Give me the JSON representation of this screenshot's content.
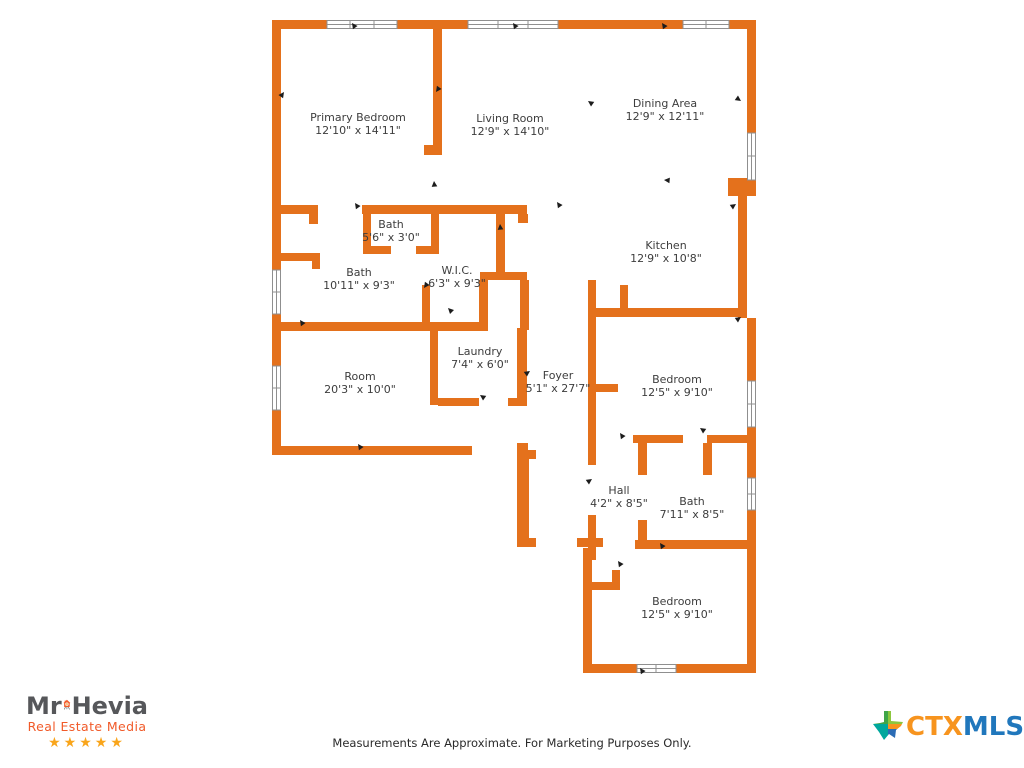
{
  "floorplan": {
    "rooms": [
      {
        "name": "Primary Bedroom",
        "dims": "12'10\" x 14'11\""
      },
      {
        "name": "Living Room",
        "dims": "12'9\" x 14'10\""
      },
      {
        "name": "Dining Area",
        "dims": "12'9\" x 12'11\""
      },
      {
        "name": "Bath",
        "dims": "5'6\" x 3'0\""
      },
      {
        "name": "Bath",
        "dims": "10'11\" x 9'3\""
      },
      {
        "name": "W.I.C.",
        "dims": "6'3\" x 9'3\""
      },
      {
        "name": "Kitchen",
        "dims": "12'9\" x 10'8\""
      },
      {
        "name": "Room",
        "dims": "20'3\" x 10'0\""
      },
      {
        "name": "Laundry",
        "dims": "7'4\" x 6'0\""
      },
      {
        "name": "Foyer",
        "dims": "5'1\" x 27'7\""
      },
      {
        "name": "Bedroom",
        "dims": "12'5\" x 9'10\""
      },
      {
        "name": "Hall",
        "dims": "4'2\" x 8'5\""
      },
      {
        "name": "Bath",
        "dims": "7'11\" x 8'5\""
      },
      {
        "name": "Bedroom",
        "dims": "12'5\" x 9'10\""
      }
    ],
    "wall_color": "#e4711c"
  },
  "footer": {
    "disclaimer": "Measurements Are Approximate. For Marketing Purposes Only."
  },
  "branding": {
    "mr_hevia": {
      "mr": "Mr",
      "hevia": "Hevia",
      "tagline": "Real Estate Media",
      "stars": "★★★★★",
      "orange": "#f15a29",
      "gray": "#56575a",
      "star_color": "#f9a51b"
    },
    "ctxmls": {
      "ctx": "CTX",
      "mls": "MLS",
      "ctx_color": "#f7941e",
      "mls_color": "#2077bc"
    }
  }
}
